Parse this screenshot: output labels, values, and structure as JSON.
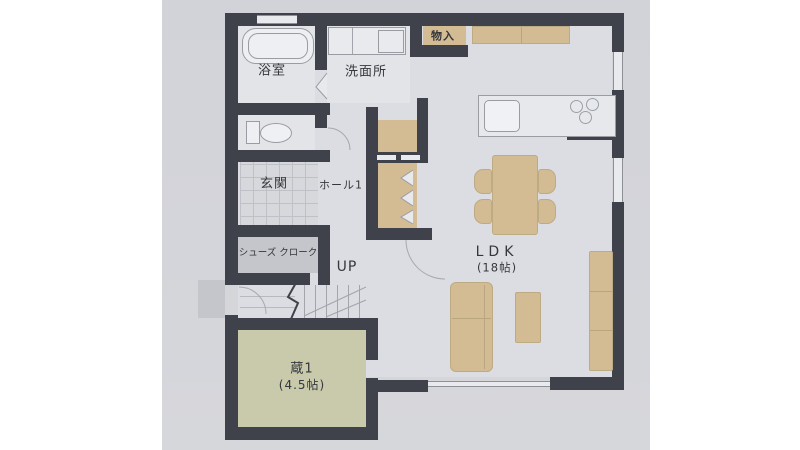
{
  "plan_type": "floor-plan",
  "colors": {
    "photo_bg": "#d3d4d9",
    "floor": "#dcdde2",
    "wall": "#3f424a",
    "furniture_tan": "#d3bb94",
    "kura_green": "#c9c9ac",
    "gray_room": "#c5c6cb",
    "fixture_line": "#9a9ca4"
  },
  "rooms": {
    "bathroom": {
      "label": "浴室"
    },
    "washroom": {
      "label": "洗面所"
    },
    "closet": {
      "label": "物入"
    },
    "entrance": {
      "label": "玄関"
    },
    "hall": {
      "label": "ホール1"
    },
    "shoe_closet": {
      "label": "シューズ クローク"
    },
    "stairs": {
      "label": "UP"
    },
    "kura": {
      "label": "蔵1",
      "size": "(4.5帖)"
    },
    "ldk": {
      "label": "LDK",
      "size": "(18帖)"
    }
  }
}
